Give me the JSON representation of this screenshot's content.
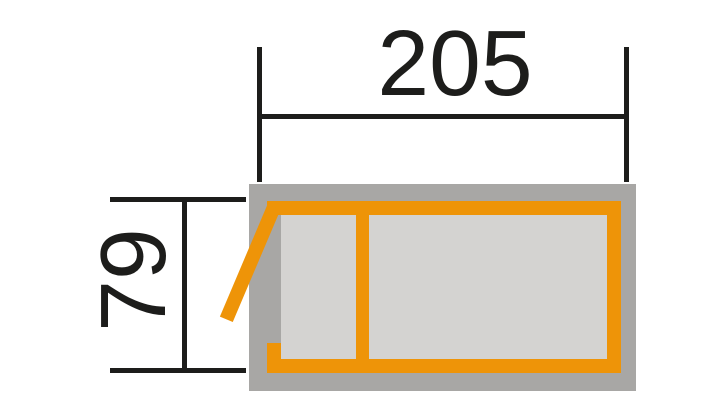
{
  "drawing": {
    "title": "product-top-view-dimension-drawing",
    "dimensions": {
      "width_label": "205",
      "height_label": "79"
    },
    "colors": {
      "line": "#1d1d1b",
      "frame_orange": "#ee9408",
      "panel_gray": "#a8a7a5",
      "cell_gray": "#d4d3d1",
      "background": "#ffffff"
    }
  }
}
